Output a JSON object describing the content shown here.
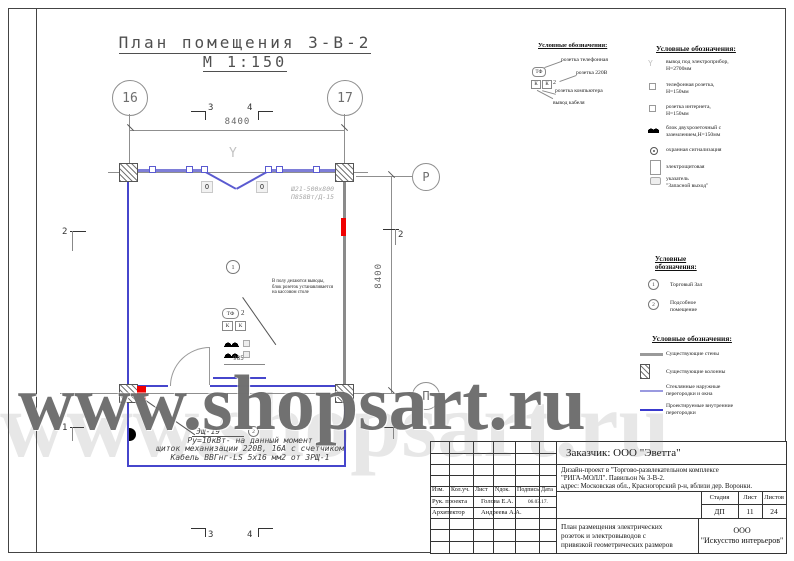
{
  "watermark": {
    "text": "www.shopsart.ru"
  },
  "drawing": {
    "title_line1": "План помещения 3-В-2",
    "title_line2": "М 1:150",
    "axes": {
      "a16": "16",
      "a17": "17",
      "aP": "Р",
      "aPi": "П"
    },
    "dims": {
      "w": "8400",
      "h": "8400",
      "m3": "3",
      "m4": "4",
      "s2": "2",
      "s1": "1",
      "d985": "985"
    },
    "marks": {
      "room1": "1",
      "room2": "2",
      "o": "О",
      "tf": "ТФ",
      "tf_n": "2",
      "k": "К",
      "y": "Y"
    },
    "note_center": [
      "В полу делаются выводы,",
      "блок розеток устанавливается",
      "на кассовом столе"
    ],
    "note_gray": [
      "Ш21-500х800",
      "П858Вт/Д-15"
    ],
    "shield": "Эщ-19",
    "note_power": [
      "Ру=10кВт- на данный момент",
      "щиток механизации 220В, 16А с счетчиком",
      "Кабель ВВГнг-LS 5х16 мм2 от ЗРЩ-1"
    ]
  },
  "legend_sockets": {
    "title": "Условные обозначения:",
    "sym_tf": "ТФ",
    "sym_k1": "К",
    "sym_k2": "К",
    "sym_2": "2",
    "items": [
      "розетка телефонная",
      "розетка 220В",
      "розетка компьютера",
      "вывод кабеля"
    ]
  },
  "legend_symbols": {
    "title": "Условные обозначения:",
    "items": [
      {
        "l1": "вывод под электроприбор,",
        "l2": "Н=2700мм"
      },
      {
        "l1": "телефонная розетка,",
        "l2": "Н=150мм"
      },
      {
        "l1": "розетка интернета,",
        "l2": "Н=150мм"
      },
      {
        "l1": "блок двухрозеточный с",
        "l2": "заземлением,Н=150мм"
      },
      {
        "l1": "охранная сигнализация",
        "l2": ""
      },
      {
        "l1": "электрощитовая",
        "l2": ""
      },
      {
        "l1": "указатель",
        "l2": "\"Запасной выход\""
      }
    ]
  },
  "legend_rooms": {
    "title_l1": "Условные",
    "title_l2": "обозначения:",
    "items": [
      {
        "num": "1",
        "l1": "Торговый Зал",
        "l2": ""
      },
      {
        "num": "2",
        "l1": "Подсобное",
        "l2": "помещение"
      }
    ]
  },
  "legend_walls": {
    "title": "Условные обозначения:",
    "items": [
      {
        "l1": "Существующие стены",
        "l2": ""
      },
      {
        "l1": "Существующие колонны",
        "l2": ""
      },
      {
        "l1": "Стеклянные наружные",
        "l2": "перегородки и окна"
      },
      {
        "l1": "Проектируемые внутренние",
        "l2": "перегородки"
      }
    ]
  },
  "titleblock": {
    "customer": "Заказчик:  ООО \"Эветта\"",
    "project_l1": "Дизайн-проект в  \"Торгово-развлекательном комплексе",
    "project_l2": "\"РИГА-МОЛЛ\". Павильон № 3-В-2.",
    "project_l3": "адрес: Московская обл., Красногорский р-н, вблизи дер. Воронки.",
    "cols": [
      "Изм.",
      "Кол.уч.",
      "Лист",
      "Nдок.",
      "Подпись",
      "Дата"
    ],
    "row1": {
      "role": "Рук. проекта",
      "name": "Голова Е.А.",
      "date": "06.03.17."
    },
    "row2": {
      "role": "Архитектор",
      "name": "Андреева А.А.",
      "date": ""
    },
    "stage": {
      "h1": "Стадия",
      "h2": "Лист",
      "h3": "Листов",
      "v1": "ДП",
      "v2": "11",
      "v3": "24"
    },
    "sheet_title": [
      "План размещения электрических",
      "розеток и электровыводов с",
      "привязкой геометрических размеров"
    ],
    "company_l1": "ООО",
    "company_l2": "\"Искусство интерьеров\""
  },
  "colors": {
    "glass_blue": "#7e7ed8",
    "partition_blue": "#4646cc",
    "existing_gray": "#8a8a8a",
    "panel_red": "#f00000"
  }
}
